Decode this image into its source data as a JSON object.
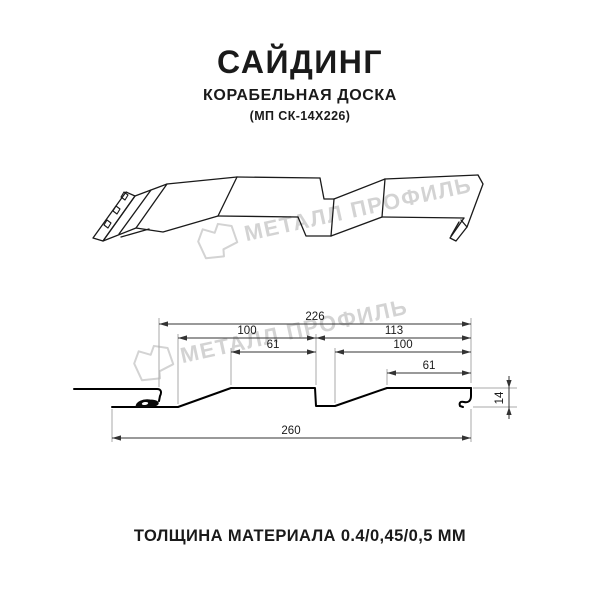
{
  "header": {
    "title": "САЙДИНГ",
    "subtitle": "КОРАБЕЛЬНАЯ ДОСКА",
    "code": "(МП СК-14Х226)"
  },
  "watermark": {
    "brand": "МЕТАЛЛ ПРОФИЛЬ"
  },
  "drawing": {
    "type": "profile-cross-section",
    "dimensions": {
      "module_width": "226",
      "left_pitch": "100",
      "left_plank_face": "61",
      "right_pitch": "113",
      "right_inner_pitch": "100",
      "right_plank_face": "61",
      "total_width": "260",
      "profile_height": "14"
    }
  },
  "footer": {
    "thickness_note": "ТОЛЩИНА МАТЕРИАЛА 0.4/0,45/0,5 ММ"
  },
  "colors": {
    "background": "#ffffff",
    "ink": "#1a1a1a",
    "profile_line": "#000000",
    "dimension_line": "#333333",
    "extension_line": "#a8a8a8",
    "watermark": "#d3d3d3"
  }
}
